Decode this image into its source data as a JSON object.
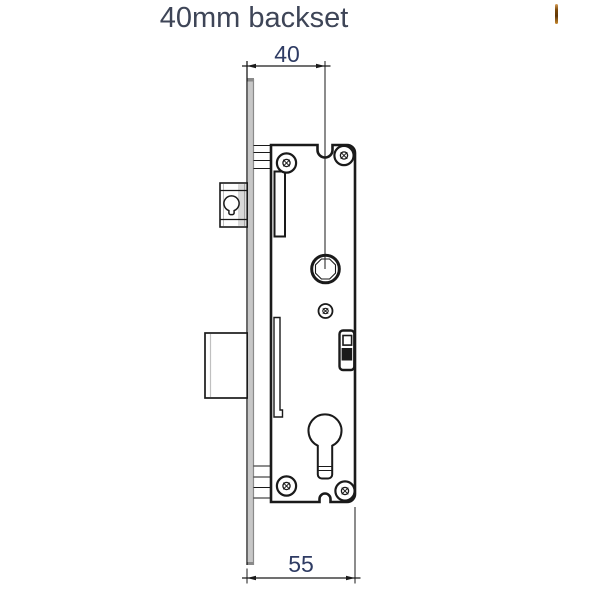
{
  "title": "40mm backset",
  "diagram": {
    "type": "technical-drawing",
    "subject": "mortise-lock-side-elevation",
    "dimensions": {
      "backset": {
        "value": "40"
      },
      "case_depth": {
        "value": "55"
      }
    },
    "parts": [
      "faceplate",
      "lock-case",
      "latch-bolt",
      "deadbolt",
      "latch-guide",
      "deadbolt-guide",
      "spindle-follower-hole",
      "adjuster-screw",
      "corner-screws",
      "snib-slider",
      "euro-cylinder-hole"
    ]
  },
  "colors": {
    "title_text": "#3e4557",
    "dimension_text": "#2e3b63",
    "line": "#1a1a1a",
    "faceplate_fill": "#c7c7c7",
    "faceplate_edge": "#8a8a8a",
    "artifact_orange": "#7a4708"
  }
}
